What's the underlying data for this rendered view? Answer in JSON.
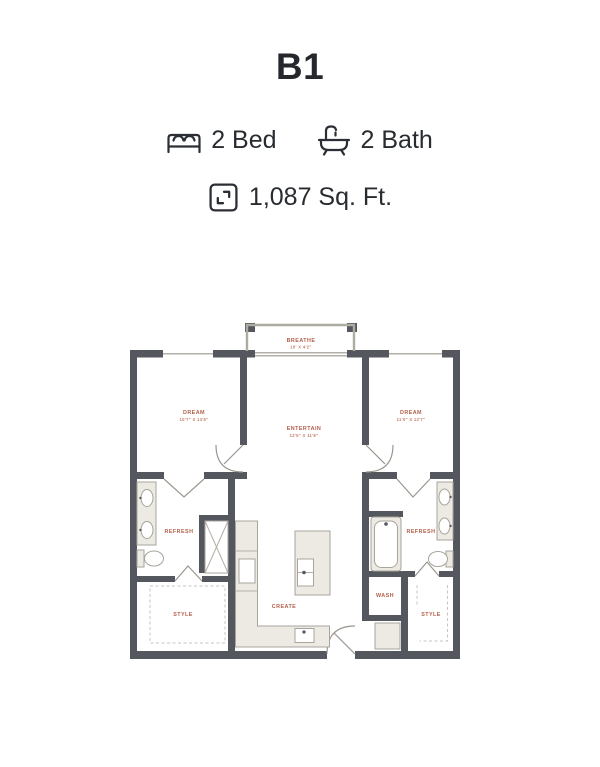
{
  "plan": {
    "title": "B1",
    "beds": "2 Bed",
    "baths": "2 Bath",
    "sqft": "1,087 Sq. Ft."
  },
  "floorplan": {
    "balcony": {
      "label": "BREATHE",
      "dims": "10' X 4'2\""
    },
    "bedroom_left": {
      "label": "DREAM",
      "dims": "10'7\" X 13'6\""
    },
    "living": {
      "label": "ENTERTAIN",
      "dims": "12'5\" X 11'8\""
    },
    "bedroom_right": {
      "label": "DREAM",
      "dims": "11'0\" X 12'7\""
    },
    "bath_left": {
      "label": "REFRESH"
    },
    "closet_left": {
      "label": "STYLE"
    },
    "kitchen": {
      "label": "CREATE"
    },
    "laundry": {
      "label": "WASH"
    },
    "bath_right": {
      "label": "REFRESH"
    },
    "closet_right": {
      "label": "STYLE"
    }
  },
  "colors": {
    "wall": "#54575d",
    "room_label": "#b4614b",
    "fixture_fill": "#edeae3",
    "text": "#282c31"
  }
}
